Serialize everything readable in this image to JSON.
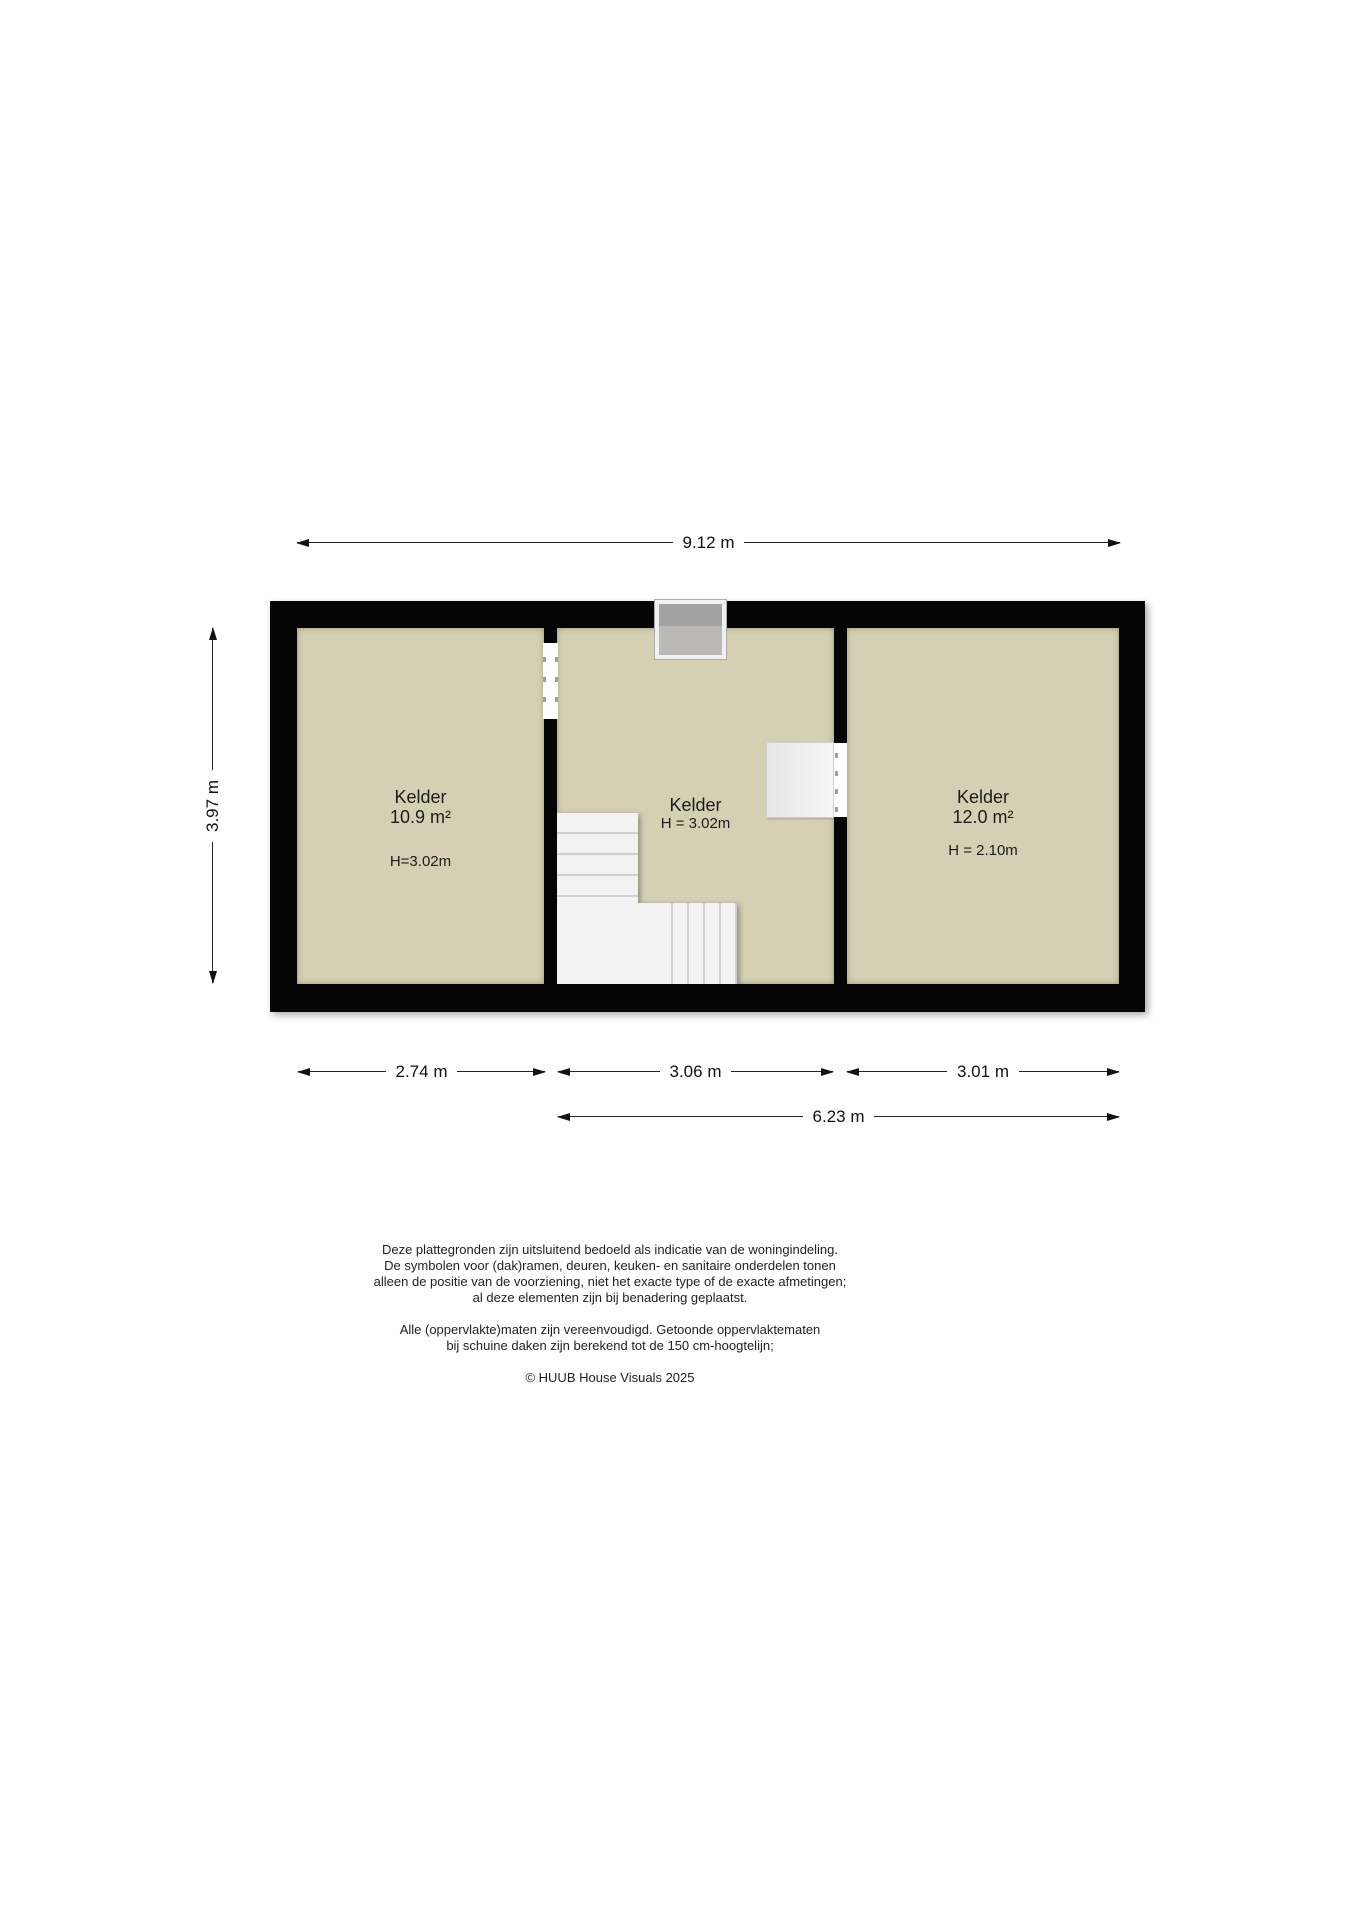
{
  "floorplan": {
    "dimensions": {
      "total_width": "9.12 m",
      "total_height": "3.97 m",
      "room1_width": "2.74 m",
      "room2_width": "3.06 m",
      "room3_width": "3.01 m",
      "rooms23_width": "6.23 m"
    },
    "rooms": [
      {
        "name": "Kelder",
        "area": "10.9 m²",
        "height_label": "H=3.02m"
      },
      {
        "name": "Kelder",
        "height_label": "H = 3.02m"
      },
      {
        "name": "Kelder",
        "area": "12.0 m²",
        "height_label": "H = 2.10m"
      }
    ],
    "colors": {
      "wall": "#050505",
      "floor": "#d5cfb4",
      "stairs": "#f2f2f2",
      "chimney_dark": "#a3a3a3",
      "chimney_light": "#bab9b5"
    }
  },
  "footer": {
    "disclaimer1": [
      "Deze plattegronden zijn uitsluitend bedoeld als indicatie van de woningindeling.",
      "De symbolen voor (dak)ramen, deuren, keuken- en sanitaire onderdelen tonen",
      "alleen de positie van de voorziening, niet het exacte type of de exacte afmetingen;",
      "al deze elementen zijn bij benadering geplaatst."
    ],
    "disclaimer2": [
      "Alle (oppervlakte)maten zijn vereenvoudigd. Getoonde oppervlaktematen",
      "bij schuine daken zijn berekend tot de 150 cm-hoogtelijn;"
    ],
    "copyright": "© HUUB House Visuals 2025"
  }
}
